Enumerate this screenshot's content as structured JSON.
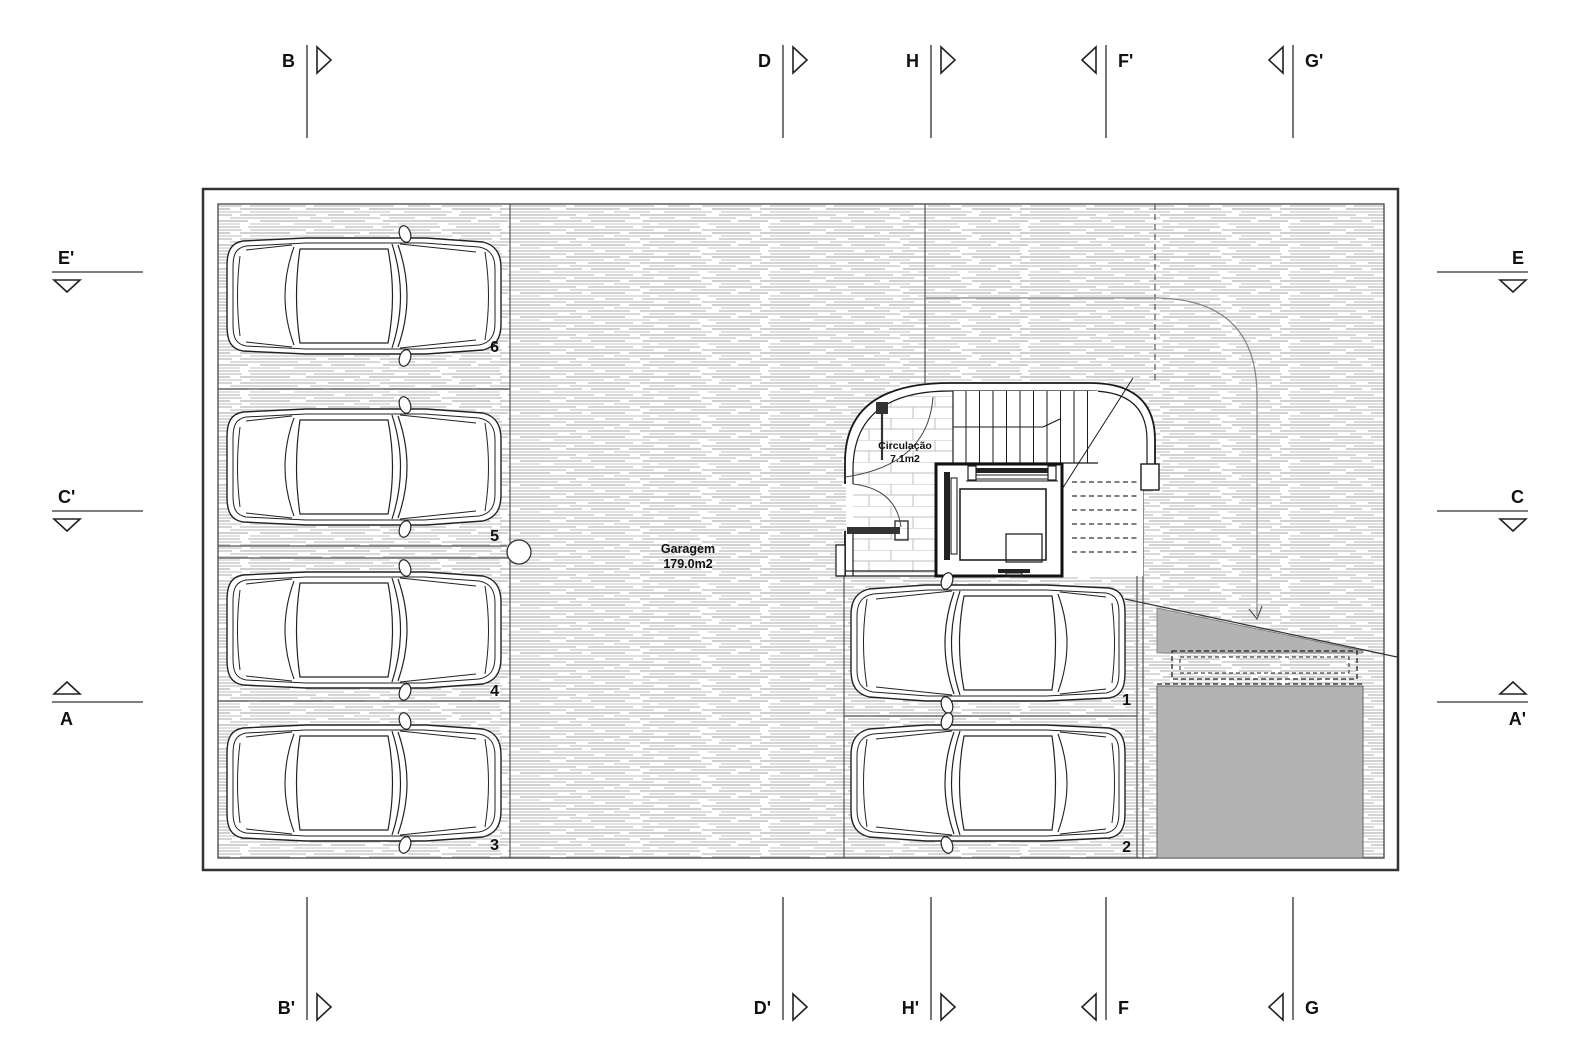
{
  "plan": {
    "rooms": {
      "garagem": {
        "name": "Garagem",
        "area": "179.0m2"
      },
      "circulacao": {
        "name": "Circulação",
        "area": "7.1m2"
      }
    },
    "parking_spaces": [
      {
        "number": "1"
      },
      {
        "number": "2"
      },
      {
        "number": "3"
      },
      {
        "number": "4"
      },
      {
        "number": "5"
      },
      {
        "number": "6"
      }
    ]
  },
  "section_markers": {
    "top": [
      {
        "label": "B"
      },
      {
        "label": "D"
      },
      {
        "label": "H"
      },
      {
        "label": "F'"
      },
      {
        "label": "G'"
      }
    ],
    "bottom": [
      {
        "label": "B'"
      },
      {
        "label": "D'"
      },
      {
        "label": "H'"
      },
      {
        "label": "F"
      },
      {
        "label": "G"
      }
    ],
    "left": [
      {
        "label": "E'"
      },
      {
        "label": "C'"
      },
      {
        "label": "A"
      }
    ],
    "right": [
      {
        "label": "E"
      },
      {
        "label": "C"
      },
      {
        "label": "A'"
      }
    ]
  },
  "colors": {
    "wall_line": "#1a1a1a",
    "hatch_line": "#c9c9c9",
    "poche_fill": "#b3b3b3",
    "marker_line": "#555555"
  }
}
